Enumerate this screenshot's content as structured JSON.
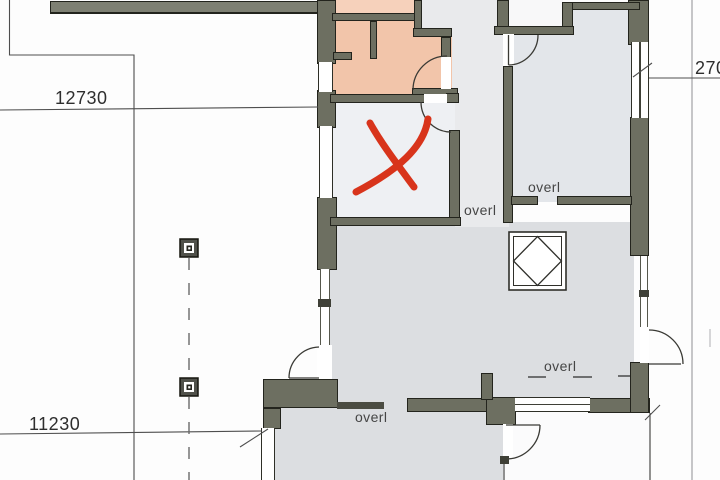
{
  "plan": {
    "dimension_labels": [
      {
        "id": "top-width",
        "value": "12730"
      },
      {
        "id": "bottom-width",
        "value": "11230"
      },
      {
        "id": "right-depth",
        "value": "270"
      }
    ],
    "lintel_labels": [
      {
        "id": "corridor",
        "value": "overl"
      },
      {
        "id": "upper-right",
        "value": "overl"
      },
      {
        "id": "lower-right",
        "value": "overl"
      },
      {
        "id": "bottom-center",
        "value": "overl"
      }
    ],
    "colors": {
      "wall": "#6d6f61",
      "wall_outline": "#23241d",
      "room_salmon": "#f2c5aa",
      "room_salmon_light": "#f6d1bb",
      "room_white": "#eef0f3",
      "room_gray": "#dcdee1",
      "room_bluegray": "#e3e6ea",
      "recess_gray": "#e9eaec",
      "red_mark": "#d8341b"
    },
    "symbols": {
      "x_mark": "red cross annotation",
      "columns": "square post symbol x2",
      "skylight": "square with inscribed diamond",
      "doors": "quarter-circle door swings"
    }
  }
}
